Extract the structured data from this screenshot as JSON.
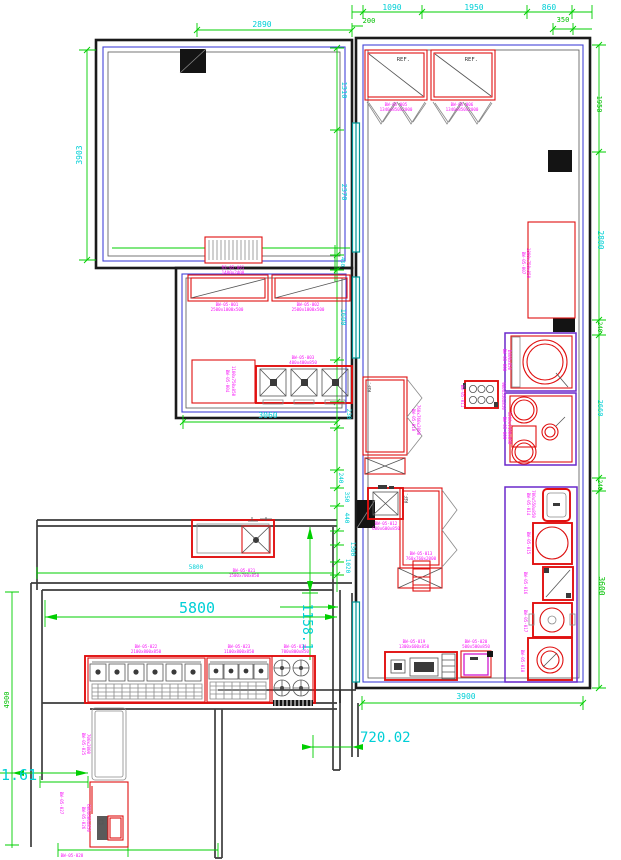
{
  "drawing": {
    "type": "kitchen-floor-plan-cad",
    "colors": {
      "wall": "#1a1a1a",
      "inner_wall_line": "#4343d8",
      "equipment_outline": "#e01010",
      "equipment_tag": "#f714f7",
      "dimension_line": "#00cf00",
      "dimension_text": "#00cfd6",
      "window_frame": "#009595",
      "column_fill": "#141414"
    }
  },
  "labels": {
    "ref": "REF."
  },
  "dims": {
    "top_left_width": "2890",
    "left_height": "3903",
    "upper_1310": "1310",
    "top_1090": "1090",
    "top_1950": "1950",
    "top_860": "860",
    "top_200": "200",
    "top_350": "350",
    "right_1950": "1950",
    "right_2800": "2800",
    "right_240a": "240",
    "right_2660": "2660",
    "right_240b": "240",
    "right_3600": "3600",
    "mid_2370": "2370",
    "mid_450": "450",
    "mid_1600": "1600",
    "mid_230": "230",
    "mid_240": "240",
    "mid_350": "350",
    "mid_440": "440",
    "mid_1300": "1300",
    "mid_1020": "1020",
    "room2_3060": "3060",
    "bottom_3900": "3900",
    "shutter_1400": "1400",
    "left_5800_small": "5800",
    "left_5800_big": "5800",
    "left_1158": "1158.1",
    "left_720": "720.02",
    "left_161": "1.61",
    "left_4900": "4900"
  },
  "tags": {
    "shutter": [
      "RS-05-001",
      "1400x2400"
    ],
    "hood1": [
      "BW-05-001",
      "2500x1000x500"
    ],
    "hood2": [
      "BW-05-002",
      "2500x1000x500"
    ],
    "stockpot": [
      "BW-05-003",
      "400x400x850"
    ],
    "prep_table": [
      "BW-05-004",
      "1100x750x850"
    ],
    "ref1": [
      "BW-05-005",
      "1340x850x2000"
    ],
    "ref2": [
      "BW-05-006",
      "1340x850x2000"
    ],
    "worktable_r": [
      "BW-05-007",
      "1800x750x850"
    ],
    "kettle": [
      "BW-05-008",
      "D800x850"
    ],
    "wok": [
      "BW-05-009",
      "1200x1100x850"
    ],
    "ref_mid": [
      "BW-05-010",
      "760x760x2000"
    ],
    "stove6_l": [
      "BW-05-011",
      "900x550x850"
    ],
    "stove6_r": [
      "BW-05-011",
      "900x550x850"
    ],
    "sink_mid": [
      "BW-05-012",
      "600x600x850"
    ],
    "ref_mid2": [
      "BW-05-013",
      "760x760x2000"
    ],
    "sink_r": [
      "BW-05-014",
      "700x550x850"
    ],
    "round_table": [
      "BW-05-015",
      "D700x850"
    ],
    "dish_table": [
      "BW-05-016",
      "600x600x850"
    ],
    "mixer": [
      "BW-05-017",
      "D500x850"
    ],
    "machine": [
      "BW-05-018",
      "600x600x850"
    ],
    "unit_a": [
      "BW-05-019",
      "1300x600x850"
    ],
    "unit_b": [
      "BW-05-020",
      "500x500x850"
    ],
    "sink_l": [
      "BW-05-021",
      "1500x700x850"
    ],
    "cook1": [
      "BW-05-022",
      "2100x800x850"
    ],
    "cook2": [
      "BW-05-023",
      "1100x800x850"
    ],
    "cook3": [
      "BW-05-024",
      "700x800x850"
    ],
    "door_l": [
      "BW-05-025",
      "700x2000"
    ],
    "small_unit": [
      "BW-05-026",
      "600x600x850"
    ],
    "tag_b1": [
      "BW-05-027",
      "300x300"
    ],
    "tag_b2": [
      "BW-05-028",
      "300x300"
    ]
  }
}
